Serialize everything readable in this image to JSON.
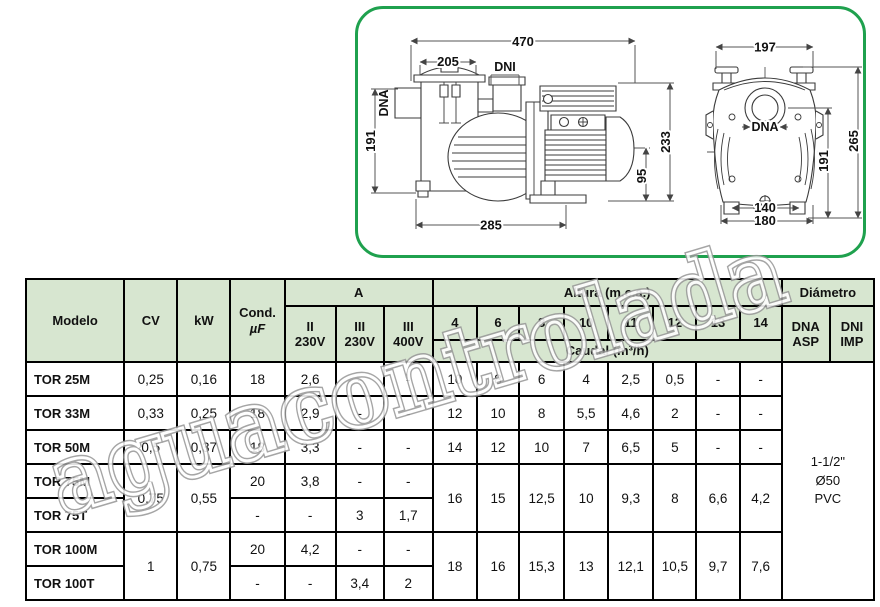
{
  "drawing": {
    "side_view": {
      "dim_top_width": "470",
      "dim_lid_width": "205",
      "label_outlet": "DNI",
      "label_inlet": "DNA",
      "dim_height_left": "191",
      "dim_height_right": "233",
      "dim_axis_height": "95",
      "dim_base_length": "285"
    },
    "front_view": {
      "dim_top_width": "197",
      "label_inlet": "DNA",
      "dim_height_total": "265",
      "dim_height_axis": "191",
      "dim_feet_inner": "140",
      "dim_feet_outer": "180"
    }
  },
  "watermark": {
    "text": "aguacontrolada"
  },
  "table": {
    "header": {
      "modelo": "Modelo",
      "cv": "CV",
      "kw": "kW",
      "cond_l1": "Cond.",
      "cond_l2": "µF",
      "amp_group": "A",
      "amp_cols": [
        {
          "l1": "II",
          "l2": "230V"
        },
        {
          "l1": "III",
          "l2": "230V"
        },
        {
          "l1": "III",
          "l2": "400V"
        }
      ],
      "altura_group": "Altura (m.c.a.)",
      "altura_cols": [
        "4",
        "6",
        "8",
        "10",
        "11",
        "12",
        "13",
        "14"
      ],
      "caudal": "Caudal (m³/h)",
      "diametro_group": "Diámetro",
      "dna_l1": "DNA",
      "dna_l2": "ASP",
      "dni_l1": "DNI",
      "dni_l2": "IMP"
    },
    "rows": [
      {
        "model": "TOR 25M",
        "cv": "0,25",
        "kw": "0,16",
        "cond": "18",
        "a1": "2,6",
        "a2": "-",
        "a3": "-",
        "q": [
          "10",
          "8",
          "6",
          "4",
          "2,5",
          "0,5",
          "-",
          "-"
        ]
      },
      {
        "model": "TOR 33M",
        "cv": "0,33",
        "kw": "0,25",
        "cond": "18",
        "a1": "2,9",
        "a2": "-",
        "a3": "-",
        "q": [
          "12",
          "10",
          "8",
          "5,5",
          "4,6",
          "2",
          "-",
          "-"
        ]
      },
      {
        "model": "TOR 50M",
        "cv": "0,5",
        "kw": "0,37",
        "cond": "18",
        "a1": "3,3",
        "a2": "-",
        "a3": "-",
        "q": [
          "14",
          "12",
          "10",
          "7",
          "6,5",
          "5",
          "-",
          "-"
        ]
      },
      {
        "model": "TOR 75M",
        "cond": "20",
        "a1": "3,8",
        "a2": "-",
        "a3": "-"
      },
      {
        "model": "TOR 75T",
        "cond": "-",
        "a1": "-",
        "a2": "3",
        "a3": "1,7"
      },
      {
        "model": "TOR 100M",
        "cond": "20",
        "a1": "4,2",
        "a2": "-",
        "a3": "-"
      },
      {
        "model": "TOR 100T",
        "cond": "-",
        "a1": "-",
        "a2": "3,4",
        "a3": "2"
      }
    ],
    "merged": {
      "cv_75": "0,75",
      "kw_75": "0,55",
      "caudal_75": [
        "16",
        "15",
        "12,5",
        "10",
        "9,3",
        "8",
        "6,6",
        "4,2"
      ],
      "cv_100": "1",
      "kw_100": "0,75",
      "caudal_100": [
        "18",
        "16",
        "15,3",
        "13",
        "12,1",
        "10,5",
        "9,7",
        "7,6"
      ],
      "diametro_l1": "1-1/2\"",
      "diametro_l2": "Ø50",
      "diametro_l3": "PVC"
    }
  }
}
